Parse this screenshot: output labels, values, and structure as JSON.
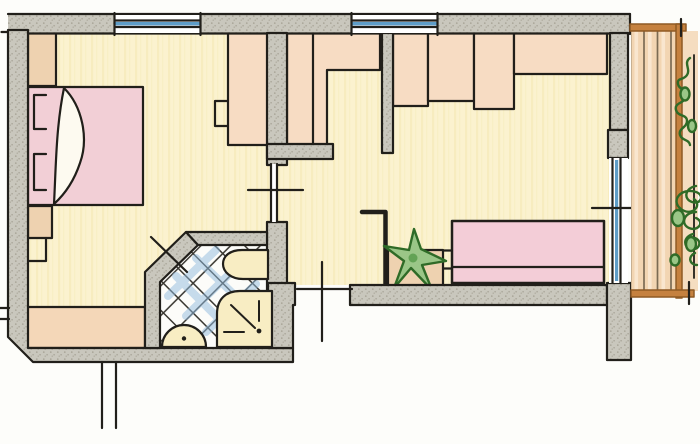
{
  "diagram": {
    "type": "hand-drawn-floor-plan",
    "style": "colored-pencil sketch, plan view",
    "rooms": [
      "bedroom",
      "bathroom",
      "hallway",
      "living-area",
      "balcony"
    ],
    "symbols": [
      "double-bed",
      "duvet-fold",
      "pillow",
      "corner-wardrobe",
      "wardrobe",
      "chair",
      "nightstand",
      "sideboard",
      "toilet",
      "washbasin",
      "shower",
      "tiled-floor",
      "built-in-closets",
      "sofa",
      "side-table",
      "potted-plant",
      "window",
      "door-swing",
      "balcony-door",
      "balcony-railing",
      "wood-decking",
      "climbing-plant"
    ],
    "window_count": 2,
    "door_count": 4
  },
  "colors": {
    "paper": "#fdfdfa",
    "line": "#211f1a",
    "wall_fill": "#c9c7bd",
    "wall_speckle": "#a5a194",
    "floor_fill": "#fbf2cf",
    "floor_grain": "#f4e6b2",
    "bed_pink": "#f2cfd6",
    "sofa_pink": "#f3cdd7",
    "duvet_white": "#fdfaf0",
    "closet_peach": "#f7dcc3",
    "cabinet_tan": "#eed2b0",
    "sideboard_peach": "#f4d7b8",
    "fixture_cream": "#f8edc3",
    "tile_white": "#fcfcf9",
    "tile_line": "#3a3831",
    "tile_blue": "#8fbade",
    "window_blue": "#5e9dc8",
    "deck_fill": "#f2d5b2",
    "deck_light": "#f9e6cf",
    "deck_line": "#7b6b53",
    "railing_orange": "#c5813f",
    "railing_dark": "#8f5a24",
    "plant_fill": "#9ac687",
    "plant_mid": "#63a355",
    "plant_dark": "#2f6b27"
  }
}
